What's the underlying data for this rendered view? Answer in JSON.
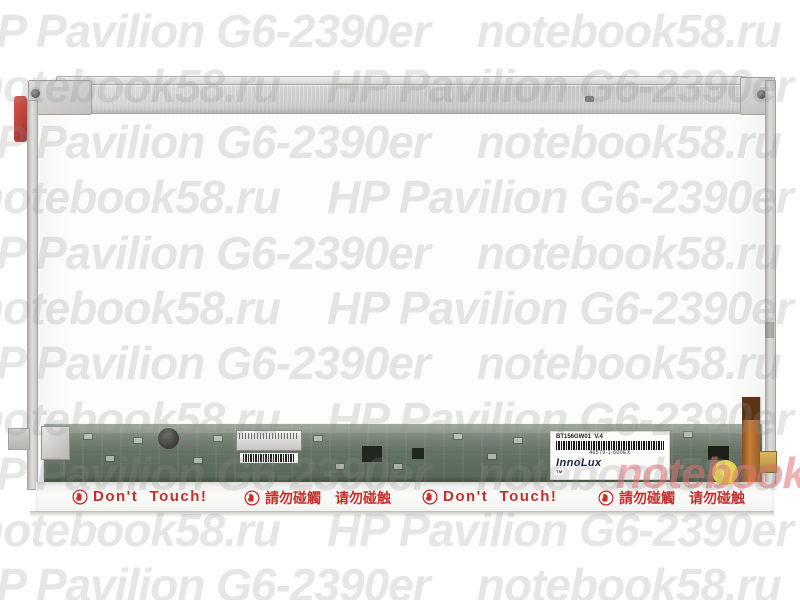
{
  "watermarks": {
    "row_a": "HP Pavilion G6-2390er    notebook58.ru",
    "row_b": "notebook58.ru    HP Pavilion G6-2390er",
    "red_overlay": "notebook58.ru",
    "gray_color": "#ebebeb",
    "red_color": "#e07272"
  },
  "panel": {
    "warning_en": "Don't  Touch!",
    "warning_zh": "請勿碰觸　请勿碰触",
    "warning_color": "#c5302c",
    "label": {
      "model": "BT156GW01  V.4",
      "serial": "46579-1-600EX",
      "brand": "InnoLux",
      "trademark": "TM"
    },
    "pcb_color": "#5d6c5f",
    "qc_sticker_color": "#e9d44a"
  }
}
